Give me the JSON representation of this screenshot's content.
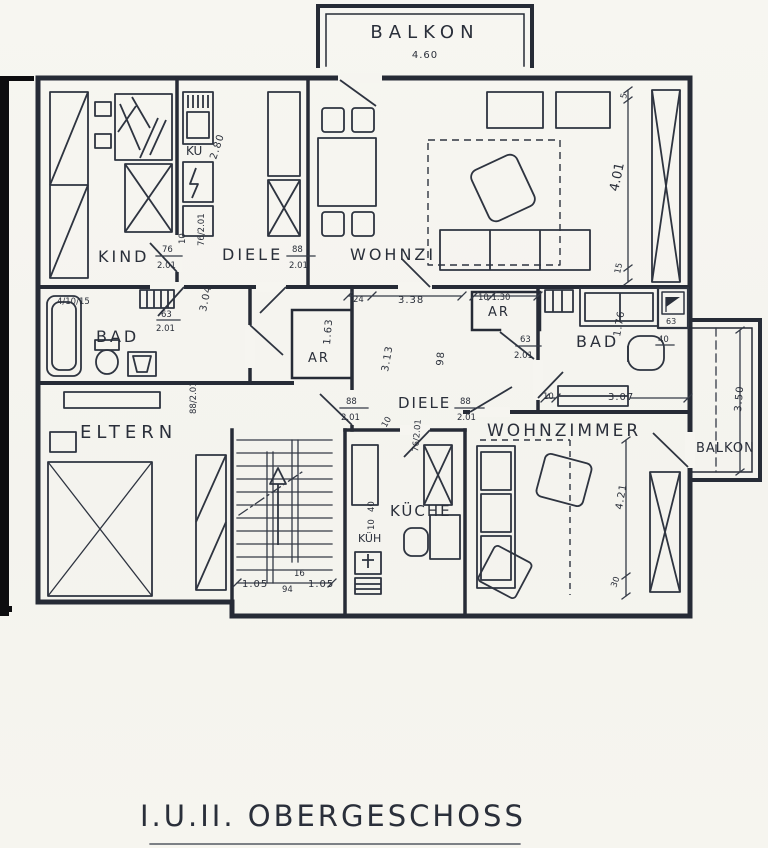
{
  "title": "I.U.II. OBERGESCHOSS",
  "colors": {
    "ink": "#2a2f3a",
    "paper": "#f6f5f0",
    "scan_edge": "#0d0d0f"
  },
  "labels": {
    "balkon_top": "BALKON",
    "balkon_top_dim": "4.60",
    "kind": "KIND",
    "kind_door_num": "76",
    "kind_door_den": "2.01",
    "kind_door_width": "10",
    "kind_door2": "76/2.01",
    "diele_left": "DIELE",
    "diele_left_num": "88",
    "diele_left_den": "2.01",
    "wohnzi_top": "WOHNZI",
    "ku": "KÜ",
    "ku_dim": "2.80",
    "dim_401": "4.01",
    "tick_5": "5",
    "tick_15": "15",
    "dim_304": "3.04",
    "bad_left": "BAD",
    "bad_left_note": "4/10/15",
    "bad_left_door_num": "63",
    "bad_left_door_den": "2.01",
    "eltern": "ELTERN",
    "eltern_door": "88/2.01",
    "ar_left": "AR",
    "dim_163": "1.63",
    "dim_313": "3.13",
    "dim_98": "98",
    "diele_right": "DIELE",
    "diele_right_num": "88",
    "diele_right_den": "2.01",
    "entry_num": "88",
    "entry_den": "2.01",
    "entry_width": "10",
    "dim_24": "24",
    "dim_338": "3.38",
    "ar_right": "AR",
    "ar_right_dims": "10  1.30",
    "ar_right_door_num": "63",
    "ar_right_door_den": "2.01",
    "bad_right": "BAD",
    "dim_176": "1.76",
    "dim_40": "40",
    "shaft": "63",
    "balkon_right": "BALKON",
    "dim_350": "3.50",
    "dim_307": "3.07",
    "dim_10_right": "10",
    "wohnzimmer": "WOHNZIMMER",
    "dim_421": "4.21",
    "tick_30": "30",
    "kueche": "KÜCHE",
    "kueh": "KÜH",
    "kueche_door": "76/2.01",
    "dim_40_kitchen": "40",
    "dim_10_kitchen": "10",
    "stairs_105a": "1.05",
    "stairs_16": "16",
    "stairs_94": "94",
    "stairs_105b": "1.05"
  }
}
